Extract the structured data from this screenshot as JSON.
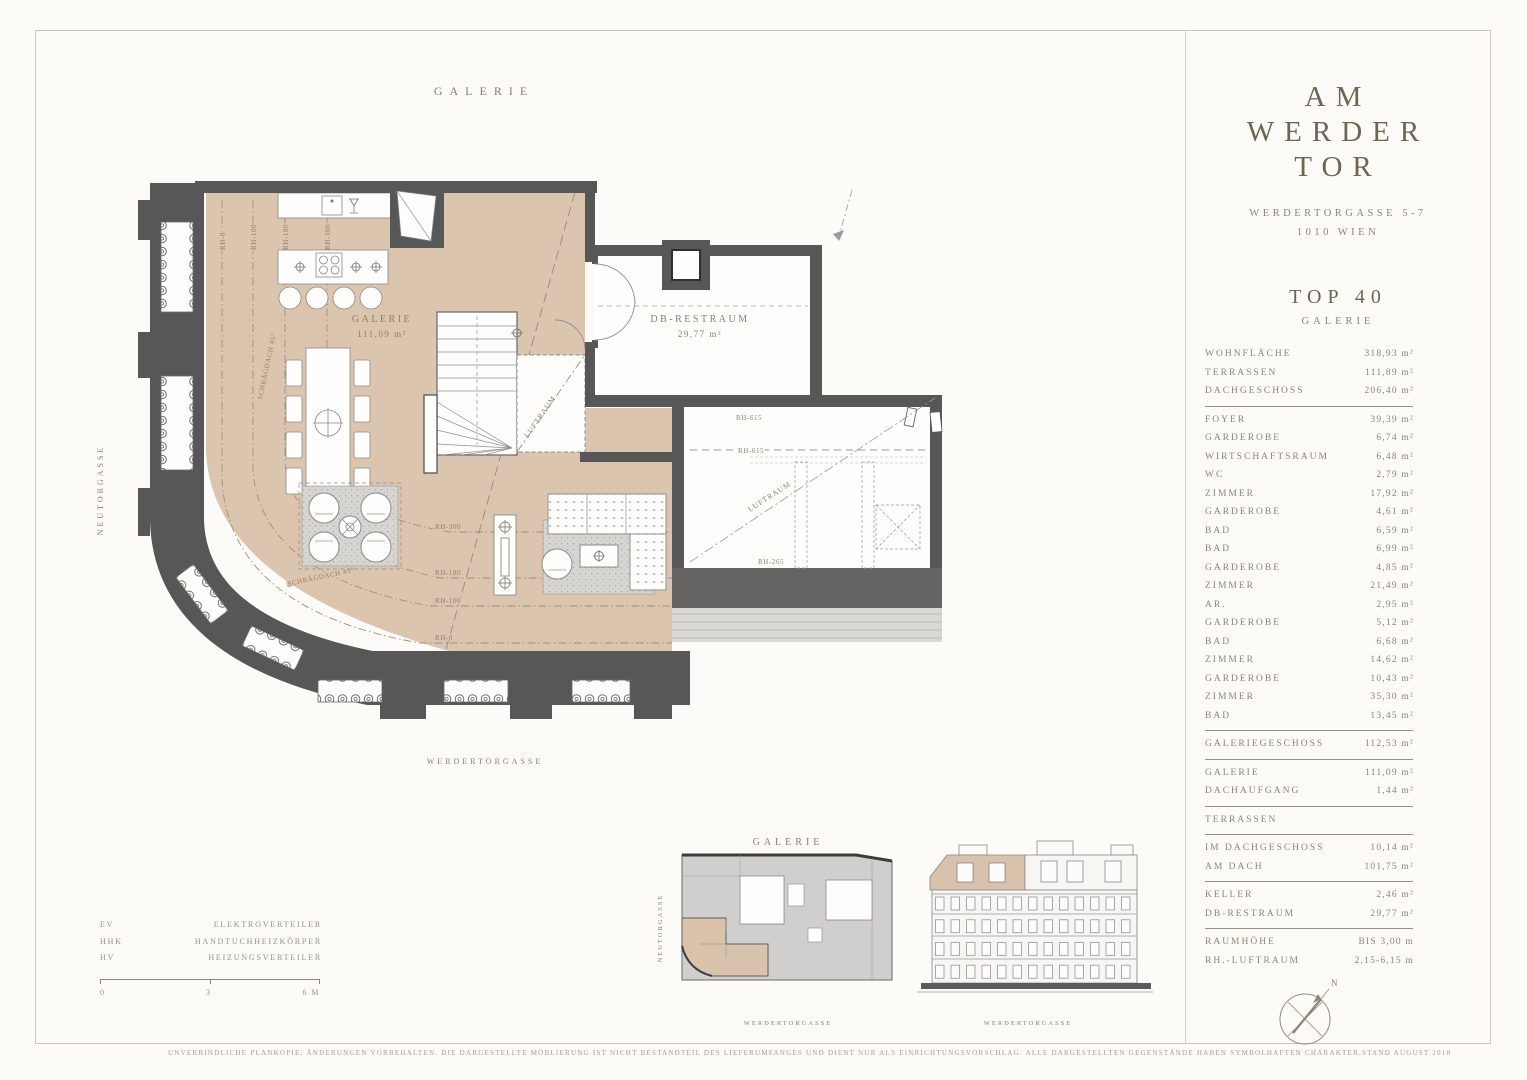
{
  "sheet": {
    "plan_title": "GALERIE",
    "disclaimer": "UNVERBINDLICHE PLANKOPIE, ÄNDERUNGEN VORBEHALTEN. DIE DARGESTELLTE MÖBLIERUNG IST NICHT BESTANDTEIL DES LIEFERUMFANGES UND DIENT NUR ALS EINRICHTUNGSVORSCHLAG. ALLE DARGESTELLTEN GEGENSTÄNDE HABEN SYMBOLHAFTEN CHARAKTER.",
    "stand_note": "STAND AUGUST 2018"
  },
  "plan": {
    "street_left": "NEUTORGASSE",
    "street_bottom": "WERDERTORGASSE",
    "galerie_label": "GALERIE",
    "galerie_area": "111,09 m²",
    "db_restraum_label": "DB-RESTRAUM",
    "db_restraum_area": "29,77 m²",
    "luftraum_label_1": "LUFTRAUM",
    "luftraum_label_2": "LUFTRAUM",
    "rh_615_a": "RH-615",
    "rh_615_b": "RH-615",
    "rh_265": "RH-265",
    "rh_300_h": "RH-300",
    "rh_180_h": "RH-180",
    "rh_100_h": "RH-100",
    "rh_0_h": "RH-0",
    "rh_300_v": "RH-300",
    "rh_180_v": "RH-180",
    "rh_100_v": "RH-100",
    "rh_0_v": "RH-0",
    "schraegdach_1": "SCHRÄGDACH 45°",
    "schraegdach_2": "SCHRÄGDACH 45°"
  },
  "sidebar": {
    "logo": [
      "AM",
      "WERDER",
      "TOR"
    ],
    "address_line1": "WERDERTORGASSE 5-7",
    "address_line2": "1010 WIEN",
    "unit": "TOP 40",
    "unit_floor": "GALERIE",
    "groups": [
      {
        "rows": [
          {
            "label": "WOHNFLÄCHE",
            "value": "318,93 m²"
          },
          {
            "label": "TERRASSEN",
            "value": "111,89 m²"
          },
          {
            "label": "DACHGESCHOSS",
            "value": "206,40 m²"
          }
        ]
      },
      {
        "rows": [
          {
            "label": "FOYER",
            "value": "39,39 m²"
          },
          {
            "label": "GARDEROBE",
            "value": "6,74 m²"
          },
          {
            "label": "WIRTSCHAFTSRAUM",
            "value": "6,48 m²"
          },
          {
            "label": "WC",
            "value": "2,79 m²"
          },
          {
            "label": "ZIMMER",
            "value": "17,92 m²"
          },
          {
            "label": "GARDEROBE",
            "value": "4,61 m²"
          },
          {
            "label": "BAD",
            "value": "6,59 m²"
          },
          {
            "label": "BAD",
            "value": "6,99 m²"
          },
          {
            "label": "GARDEROBE",
            "value": "4,85 m²"
          },
          {
            "label": "ZIMMER",
            "value": "21,49 m²"
          },
          {
            "label": "AR.",
            "value": "2,95 m²"
          },
          {
            "label": "GARDEROBE",
            "value": "5,12 m²"
          },
          {
            "label": "BAD",
            "value": "6,68 m²"
          },
          {
            "label": "ZIMMER",
            "value": "14,62 m²"
          },
          {
            "label": "GARDEROBE",
            "value": "10,43 m²"
          },
          {
            "label": "ZIMMER",
            "value": "35,30 m²"
          },
          {
            "label": "BAD",
            "value": "13,45 m²"
          }
        ]
      },
      {
        "rows": [
          {
            "label": "GALERIEGESCHOSS",
            "value": "112,53 m²"
          }
        ]
      },
      {
        "rows": [
          {
            "label": "GALERIE",
            "value": "111,09 m²"
          },
          {
            "label": "DACHAUFGANG",
            "value": "1,44 m²"
          }
        ]
      },
      {
        "rows": [
          {
            "label": "TERRASSEN",
            "value": ""
          }
        ]
      },
      {
        "rows": [
          {
            "label": "IM DACHGESCHOSS",
            "value": "10,14 m²"
          },
          {
            "label": "AM DACH",
            "value": "101,75 m²"
          }
        ]
      },
      {
        "rows": [
          {
            "label": "KELLER",
            "value": "2,46 m²"
          },
          {
            "label": "DB-RESTRAUM",
            "value": "29,77 m²"
          }
        ]
      },
      {
        "rows": [
          {
            "label": "RAUMHÖHE",
            "value": "BIS 3,00 m"
          },
          {
            "label": "RH.-LUFTRAUM",
            "value": "2,15-6,15 m"
          }
        ]
      }
    ]
  },
  "legend": {
    "items": [
      {
        "abbr": "EV",
        "label": "ELEKTROVERTEILER"
      },
      {
        "abbr": "HHK",
        "label": "HANDTUCHHEIZKÖRPER"
      },
      {
        "abbr": "HV",
        "label": "HEIZUNGSVERTEILER"
      }
    ],
    "scale": {
      "start": "0",
      "mid": "3",
      "end": "6 M"
    }
  },
  "thumbnails": {
    "plan_title": "GALERIE",
    "plan_street_left": "NEUTORGASSE",
    "plan_street_bottom": "WERDERTORGASSE",
    "elevation_street": "WERDERTORGASSE"
  },
  "compass": {
    "north_label": "N"
  },
  "colors": {
    "accent_tan": "#dcc5ae",
    "wall": "#575757",
    "text": "#8d8271"
  }
}
